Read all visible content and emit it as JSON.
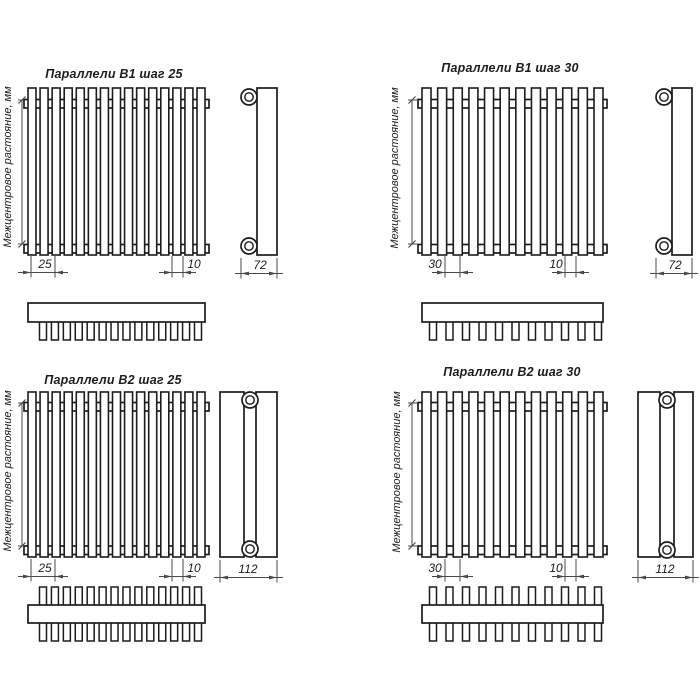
{
  "page": {
    "background": "#ffffff",
    "line_color": "#1c1c1c",
    "dim_color": "#4a4a4a",
    "text_color": "#1d1d1d"
  },
  "y_axis_label": "Межцентровое растояние, мм",
  "quadrants": [
    {
      "id": "b1-step-25",
      "title": "Параллели В1 шаг 25",
      "step_dim": "25",
      "tube_dim": "10",
      "depth_dim": "72",
      "tube_count": 15,
      "top_tube_count": 14,
      "rows": 1
    },
    {
      "id": "b1-step-30",
      "title": "Параллели В1 шаг 30",
      "step_dim": "30",
      "tube_dim": "10",
      "depth_dim": "72",
      "tube_count": 12,
      "top_tube_count": 11,
      "rows": 1
    },
    {
      "id": "b2-step-25",
      "title": "Параллели В2 шаг 25",
      "step_dim": "25",
      "tube_dim": "10",
      "depth_dim": "112",
      "tube_count": 15,
      "top_tube_count": 14,
      "rows": 2
    },
    {
      "id": "b2-step-30",
      "title": "Параллели В2 шаг 30",
      "step_dim": "30",
      "tube_dim": "10",
      "depth_dim": "112",
      "tube_count": 12,
      "top_tube_count": 11,
      "rows": 2
    }
  ]
}
